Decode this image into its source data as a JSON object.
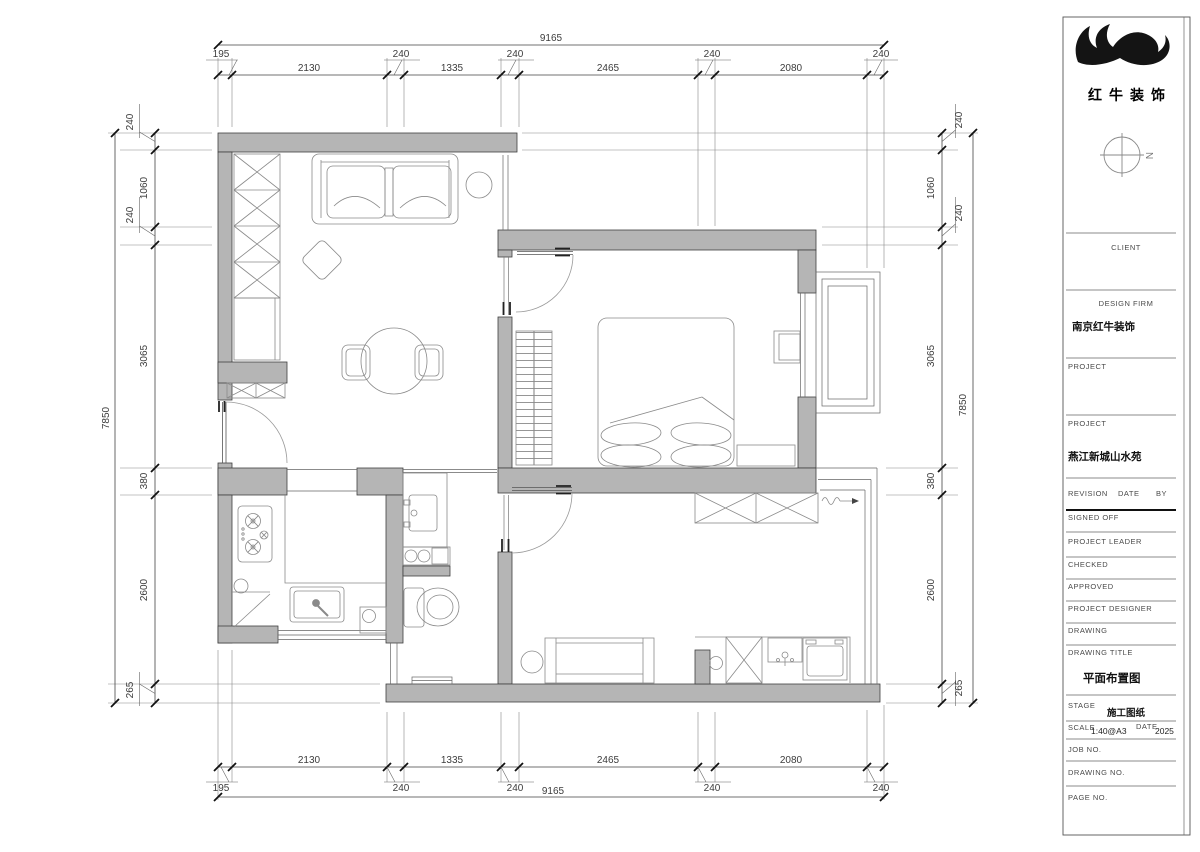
{
  "colors": {
    "wall_fill": "#b5b5b5",
    "wall_stroke": "#3f3f3f",
    "dim_line": "#555555",
    "furniture_line": "#8a8a8a",
    "logo": "#141414"
  },
  "logo": {
    "company": "红牛装饰"
  },
  "compass": {
    "label": "N"
  },
  "dims": {
    "top": {
      "overall": "9165",
      "large": [
        "2130",
        "1335",
        "2465",
        "2080"
      ],
      "small": [
        "195",
        "240",
        "240",
        "240",
        "240"
      ]
    },
    "bottom": {
      "overall": "9165",
      "large": [
        "2130",
        "1335",
        "2465",
        "2080"
      ],
      "small": [
        "195",
        "240",
        "240",
        "240",
        "240"
      ]
    },
    "left": {
      "overall": "7850",
      "large": [
        "1060",
        "3065",
        "380",
        "2600"
      ],
      "small": [
        "240",
        "240",
        "265"
      ]
    },
    "right": {
      "overall": "7850",
      "large": [
        "1060",
        "3065",
        "380",
        "2600"
      ],
      "small": [
        "240",
        "240",
        "265"
      ]
    }
  },
  "titleblock": {
    "client_label": "CLIENT",
    "design_firm_label": "DESIGN FIRM",
    "design_firm": "南京红牛装饰",
    "project_label": "PROJECT",
    "project2_label": "PROJECT",
    "project_name": "燕江新城山水苑",
    "revision_label": "REVISION",
    "date_label": "DATE",
    "by_label": "BY",
    "signed_off_label": "SIGNED OFF",
    "project_leader_label": "PROJECT LEADER",
    "checked_label": "CHECKED",
    "approved_label": "APPROVED",
    "project_designer_label": "PROJECT DESIGNER",
    "drawing_label": "DRAWING",
    "drawing_title_label": "DRAWING TITLE",
    "drawing_title": "平面布置图",
    "stage_label": "STAGE",
    "stage": "施工图纸",
    "scale_label": "SCALE",
    "scale": "1:40@A3",
    "date2_label": "DATE",
    "date": "2025",
    "job_no_label": "JOB NO.",
    "drawing_no_label": "DRAWING NO.",
    "page_no_label": "PAGE NO."
  }
}
